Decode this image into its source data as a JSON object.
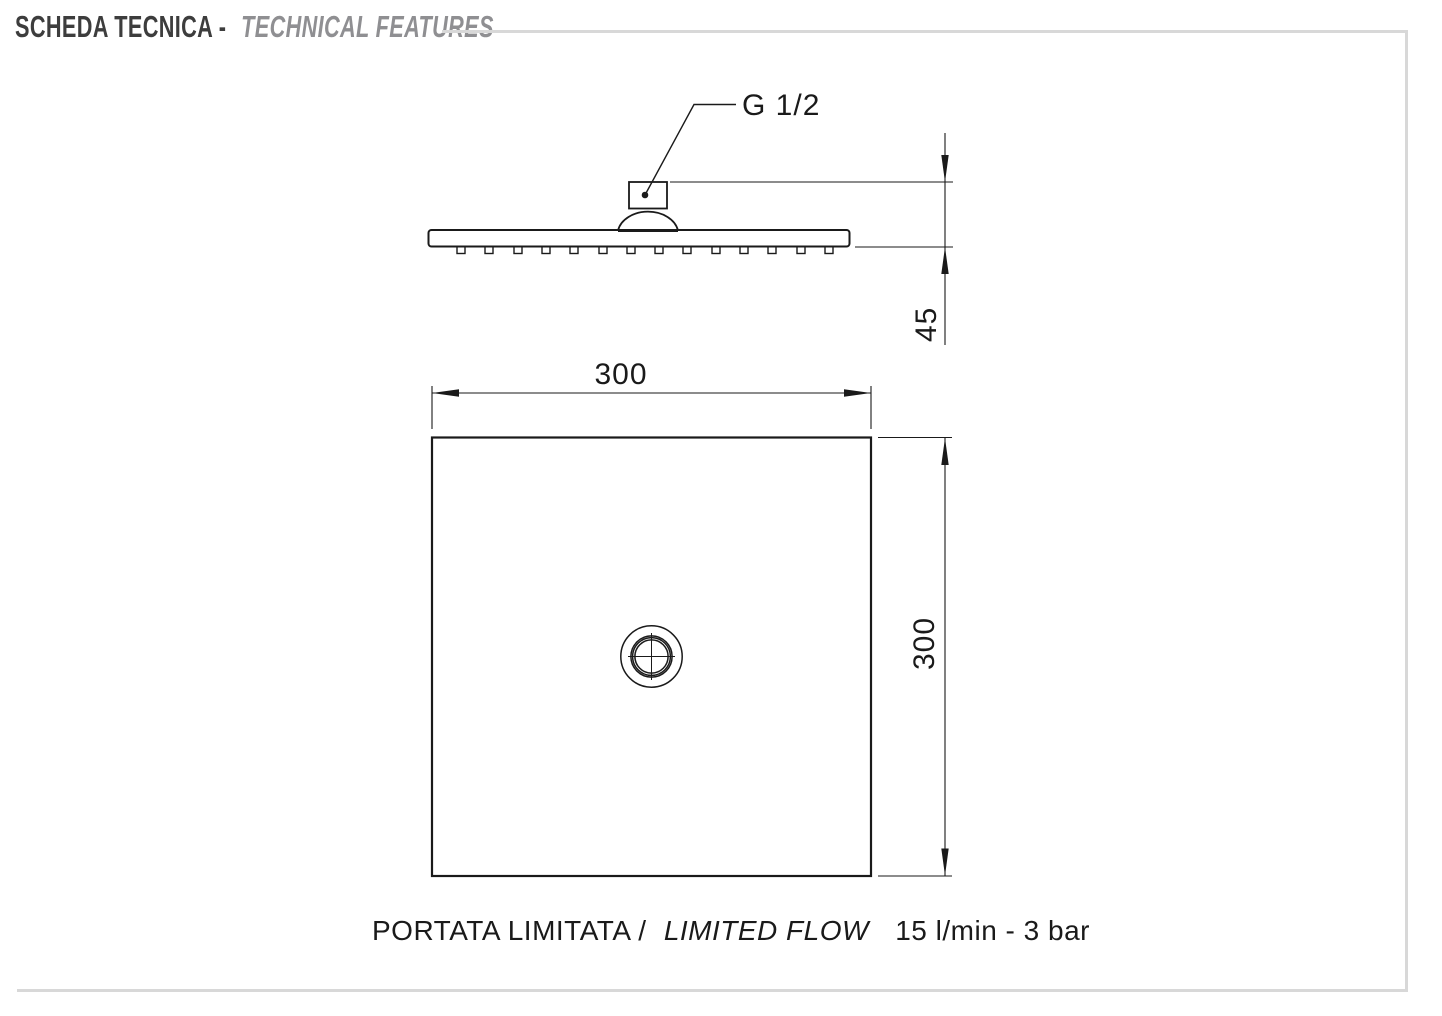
{
  "header": {
    "title_it": "SCHEDA TECNICA -",
    "title_en": "TECHNICAL FEATURES"
  },
  "drawing": {
    "connection_label": "G 1/2",
    "dimensions": {
      "head_height": "45",
      "head_width": "300",
      "head_depth": "300"
    },
    "caption": {
      "label_it": "PORTATA LIMITATA /",
      "label_en": "LIMITED FLOW",
      "value": "15 l/min - 3 bar"
    }
  },
  "colors": {
    "title_primary": "#3d3d3d",
    "title_secondary": "#8f8f92",
    "frame_rule": "#d8d8d8",
    "drawing_line": "#1a1a1a"
  }
}
